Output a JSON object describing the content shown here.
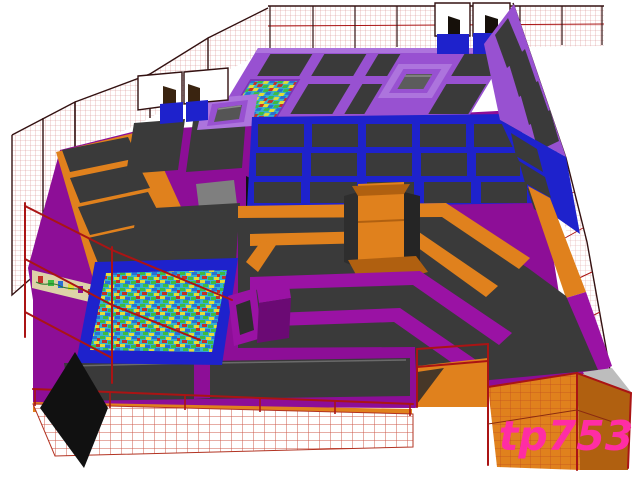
{
  "watermark": {
    "text": "tp753",
    "color": "#ff2da4"
  },
  "palette": {
    "bg": "#ffffff",
    "mat": "#3a3a3a",
    "mat-light": "#474747",
    "violet": "#9851d1",
    "violet-light": "#ad74dd",
    "violet-dark": "#7c35b5",
    "magenta": "#8d0e97",
    "magenta-light": "#9a12a4",
    "magenta-dark": "#6b0a74",
    "blue": "#1e22cc",
    "blue-dark": "#13169c",
    "orange": "#e0811d",
    "orange-dark": "#b06010",
    "orange-deep": "#8a4a10",
    "wire-red": "#aa1414",
    "wire-dark": "#331111",
    "mesh-line": "#d89090",
    "foam-base": "#35b2cf",
    "foam-green": "#3dbb42",
    "foam-yellow": "#e3dd38",
    "foam-red": "#c43128",
    "foam-blue": "#2a6fd4",
    "watermark-pink": "#ff2da4",
    "shadow-black": "#111111",
    "gray-wall": "#bdbdbd",
    "gray-top": "#7f7f7f",
    "graffiti-bg": "#ddd2a8"
  },
  "scene": {
    "description": "3D render of an indoor trampoline park",
    "areas": [
      "perimeter safety netting",
      "back wall trampoline deck (violet)",
      "small foam cube pit (back deck)",
      "dunk platforms with angled boards",
      "main trampoline court (blue grid)",
      "angled wall trampolines (violet / blue / orange bands, right side)",
      "orange trampoline court (left)",
      "graffiti side panel",
      "large foam cube pit (blue rim)",
      "tumble courts and raised purple box",
      "orange walkways and center tower",
      "purple lane dividers (dodgeball / tumble lanes)",
      "front trampoline row",
      "front mesh fence",
      "orange party box with wire fence (bottom right)",
      "black diamond marker (bottom left)"
    ]
  }
}
